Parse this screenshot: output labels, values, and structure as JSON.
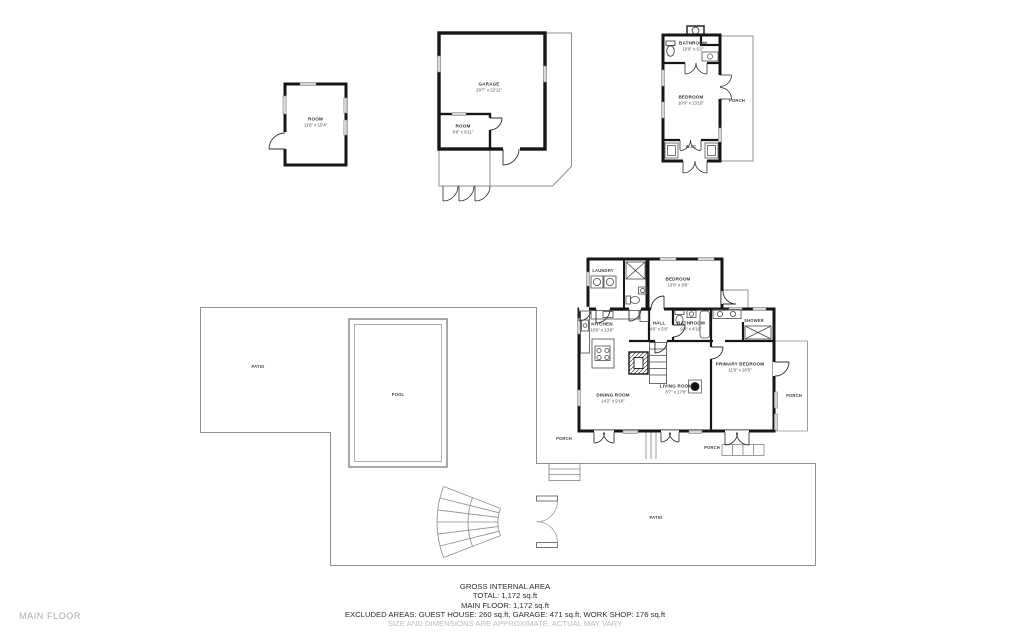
{
  "floor_label": "MAIN FLOOR",
  "footer": {
    "line1": "GROSS INTERNAL AREA",
    "line2": "TOTAL: 1,172 sq.ft",
    "line3": "MAIN FLOOR: 1,172 sq.ft",
    "line4": "EXCLUDED AREAS: GUEST HOUSE: 260 sq.ft, GARAGE: 471 sq.ft, WORK SHOP: 176 sq.ft",
    "line5": "SIZE AND DIMENSIONS ARE APPROXIMATE, ACTUAL MAY VARY"
  },
  "rooms": {
    "workshop": {
      "name": "ROOM",
      "dims": "11'6\" x 15'4\""
    },
    "garage": {
      "name": "GARAGE",
      "dims": "20'7\" x 22'11\""
    },
    "garage_room": {
      "name": "ROOM",
      "dims": "9'8\" x 6'11\""
    },
    "guest_bathroom": {
      "name": "BATHROOM",
      "dims": "10'9\" x 5'2\""
    },
    "guest_bedroom": {
      "name": "BEDROOM",
      "dims": "10'0\" x 13'10\""
    },
    "guest_wic": {
      "name": "W.I.C"
    },
    "guest_porch": {
      "name": "PORCH"
    },
    "laundry": {
      "name": "LAUNDRY"
    },
    "bedroom": {
      "name": "BEDROOM",
      "dims": "13'0\" x 9'6\""
    },
    "kitchen": {
      "name": "KITCHEN",
      "dims": "10'6\" x 13'6\""
    },
    "hall": {
      "name": "HALL",
      "dims": "4'0\" x 5'6\""
    },
    "bathroom": {
      "name": "BATHROOM",
      "dims": "9'9\" x 4'10\""
    },
    "shower": {
      "name": "SHOWER"
    },
    "primary_bedroom": {
      "name": "PRIMARY BEDROOM",
      "dims": "11'9\" x 20'5\""
    },
    "living_room": {
      "name": "LIVING ROOM",
      "dims": "8'7\" x 17'8\""
    },
    "dining_room": {
      "name": "DINING ROOM",
      "dims": "14'2\" x 9'10\""
    },
    "porch_left": {
      "name": "PORCH"
    },
    "porch_bottom": {
      "name": "PORCH"
    },
    "porch_right": {
      "name": "PORCH"
    },
    "patio_left": {
      "name": "PATIO"
    },
    "patio_bottom": {
      "name": "PATIO"
    },
    "pool": {
      "name": "POOL"
    }
  }
}
